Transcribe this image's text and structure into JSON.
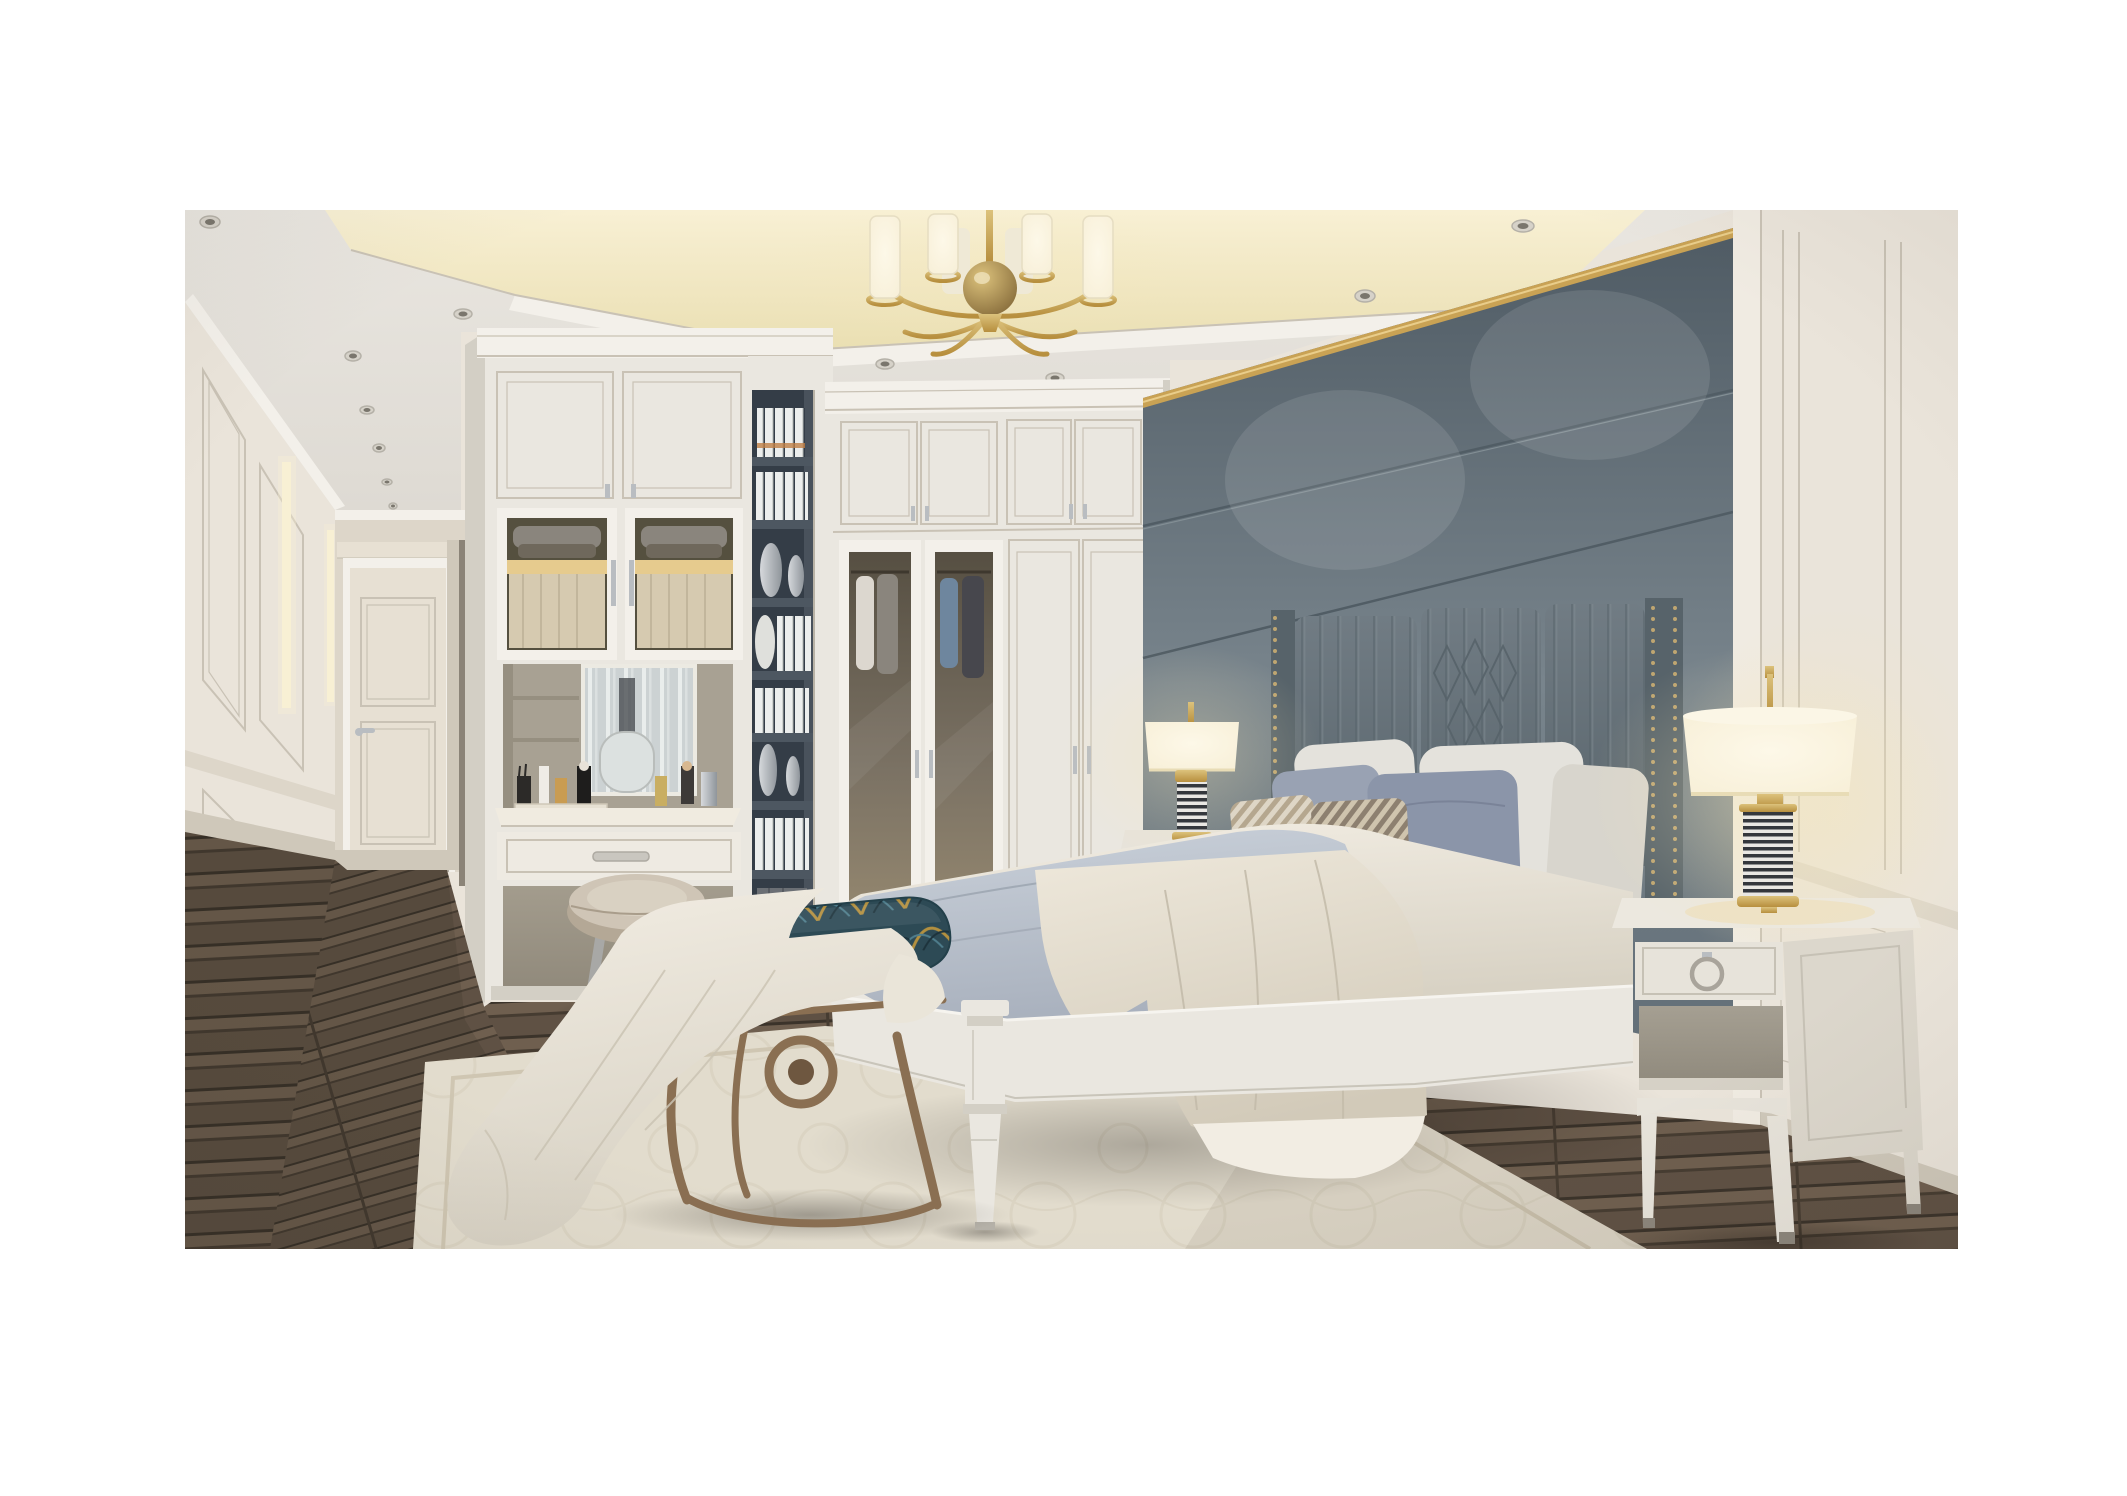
{
  "meta": {
    "title": "Photorealistic rendering of a neoclassical light-luxury bedroom with white built-in wardrobes, a gray upholstered bed wall, brass chandelier and dressing vanity",
    "type": "interior-render",
    "room": "bedroom"
  },
  "scene": {
    "objects": [
      {
        "id": "ceiling-cove",
        "label": "recessed tray ceiling with warm cove lighting",
        "colors": [
          "cove-bright",
          "ceiling"
        ]
      },
      {
        "id": "chandelier",
        "label": "brass chandelier with cylindrical white glass shades",
        "colors": [
          "brass",
          "lamp-shade"
        ]
      },
      {
        "id": "spotlights",
        "label": "recessed ceiling downlights",
        "colors": [
          "ceiling-dark"
        ]
      },
      {
        "id": "hallway",
        "label": "paneled entry hallway with interior door",
        "colors": [
          "wall",
          "door"
        ]
      },
      {
        "id": "interior-door",
        "label": "cream two-panel interior door with lever handle",
        "colors": [
          "door",
          "silver"
        ]
      },
      {
        "id": "led-niches",
        "label": "vertical LED-lit wall niches in hallway",
        "colors": [
          "cove-bright"
        ]
      },
      {
        "id": "wardrobe",
        "label": "white built-in floor-to-ceiling wardrobe, two glass doors showing shirts",
        "colors": [
          "frame-white",
          "glass-dark"
        ]
      },
      {
        "id": "vanity",
        "label": "built-in dressing vanity niche with mirror, cosmetics, drawer and stool",
        "colors": [
          "frame-white",
          "niche",
          "mirror-a"
        ]
      },
      {
        "id": "glass-cabinets",
        "label": "lit glass-front cabinets with folded knitwear",
        "colors": [
          "glass-warm",
          "clothes-gray"
        ]
      },
      {
        "id": "bookshelf",
        "label": "dark open shelf column with white books and silver vases",
        "colors": [
          "shelf-dark",
          "book",
          "silver"
        ]
      },
      {
        "id": "wall-panel",
        "label": "large gray-green upholstered wall panel with gold trim",
        "colors": [
          "panel-2",
          "gold"
        ]
      },
      {
        "id": "headboard",
        "label": "channel-tufted gray headboard with nailhead wings",
        "colors": [
          "headboard-1",
          "nailhead"
        ]
      },
      {
        "id": "bed",
        "label": "white wood king bed with gray duvet, cream blanket and draped sheet",
        "colors": [
          "frame-white",
          "duvet-1",
          "blanket-1"
        ]
      },
      {
        "id": "pillows",
        "label": "two rows of pillows: white, blue-gray, striped taupe accent pillows",
        "colors": [
          "pillow-white",
          "pillow-blue",
          "stripe-a"
        ]
      },
      {
        "id": "bench",
        "label": "foot-of-bed bench, teal and gold palm-patterned seat on bronze frame",
        "colors": [
          "bench-teal",
          "bench-gold",
          "bronze"
        ]
      },
      {
        "id": "throw",
        "label": "white throw blanket draped over bench onto rug",
        "colors": [
          "sheet-1"
        ]
      },
      {
        "id": "stool",
        "label": "round cream leather vanity stool",
        "colors": [
          "stool-seat",
          "stool-leg"
        ]
      },
      {
        "id": "nightstand-left",
        "label": "left nightstand with striped-column brass table lamp",
        "colors": [
          "nightstand",
          "stripe-dark",
          "brass"
        ]
      },
      {
        "id": "nightstand-right",
        "label": "right one-drawer nightstand with ring pull and open shelf",
        "colors": [
          "nightstand",
          "silver"
        ]
      },
      {
        "id": "table-lamps",
        "label": "pair of lit table lamps, cream drum shades, black-and-white coiled bodies, brass fittings",
        "colors": [
          "lamp-shade",
          "stripe-dark",
          "brass"
        ]
      },
      {
        "id": "rug",
        "label": "cream tone-on-tone patterned area rug",
        "colors": [
          "rug",
          "rug-pat"
        ]
      },
      {
        "id": "floor",
        "label": "dark walnut plank wood floor",
        "colors": [
          "wood-1",
          "wood-2"
        ]
      },
      {
        "id": "right-wall",
        "label": "cream classical wall paneling with chair rail and baseboard",
        "colors": [
          "wall",
          "wall-dark"
        ]
      }
    ]
  },
  "palette": {
    "page-bg": "#ffffff",
    "wall": "#eae4da",
    "wall-dark": "#ddd6c9",
    "wall-shadow": "#cfc8ba",
    "line": "#c9c2b5",
    "ceiling": "#e9e6e0",
    "ceiling-dark": "#dedad3",
    "crown": "#f3f0ea",
    "cove-bright": "#f8f0d4",
    "cove-warm": "#eadfb2",
    "door": "#e7e0d3",
    "glass-dark": "#564f42",
    "glass-mid": "#7b7264",
    "glass-warm": "#94876f",
    "clothes-white": "#dcd7cf",
    "clothes-gray": "#8a857d",
    "clothes-blue": "#6e869e",
    "clothes-dark": "#47474d",
    "niche": "#a8a193",
    "kneehole": "#a39c8d",
    "mirror-a": "#ccd2d3",
    "mirror-b": "#e9edec",
    "shelf-dark": "#343d47",
    "shelf-board": "#4d5761",
    "book": "#eceeed",
    "book-accent": "#c08045",
    "silver": "#b9bdc1",
    "silver-dark": "#8f959b",
    "panel-1": "#4f5b64",
    "panel-2": "#78848c",
    "panel-3": "#626e77",
    "gold": "#c9a254",
    "gold-dark": "#9a7836",
    "headboard-1": "#717c84",
    "headboard-2": "#57636a",
    "nailhead": "#bfa671",
    "pillow-white": "#e4e2dc",
    "pillow-white-2": "#d8d5cd",
    "pillow-blue": "#8b95a9",
    "pillow-blue-2": "#99a2b3",
    "stripe-a": "#b5a78f",
    "stripe-b": "#8d8070",
    "stripe-c": "#ded6c6",
    "duvet-1": "#cad1da",
    "duvet-2": "#a6aebb",
    "blanket-1": "#eee8db",
    "blanket-2": "#d2cab9",
    "sheet-1": "#f2ede3",
    "sheet-2": "#d7d1c3",
    "frame-white": "#eae7e0",
    "frame-shadow": "#d3cfc5",
    "wood-1": "#5f5144",
    "wood-2": "#463c31",
    "wood-3": "#6f5f4f",
    "wood-4": "#3b332a",
    "rug": "#e2dccd",
    "rug-border": "#cfc6b2",
    "rug-pat": "#d5cdba",
    "nightstand": "#e7e3da",
    "nightstand-side": "#dcd7cc",
    "nightstand-shadow": "#b9b3a6",
    "lamp-shade": "#f7efd7",
    "lamp-shade-rim": "#e8dcb6",
    "glow": "#f6e7b8",
    "brass": "#b78f3e",
    "brass-light": "#dcc27c",
    "stripe-dark": "#34373c",
    "stripe-light": "#e9e7e3",
    "bench-teal": "#2d4a55",
    "bench-gold": "#b3903f",
    "bench-blue": "#4e7d8c",
    "bronze": "#8a6f52",
    "stool-seat": "#cfc5b6",
    "stool-side": "#b4a896",
    "stool-leg": "#a8a8a6"
  }
}
